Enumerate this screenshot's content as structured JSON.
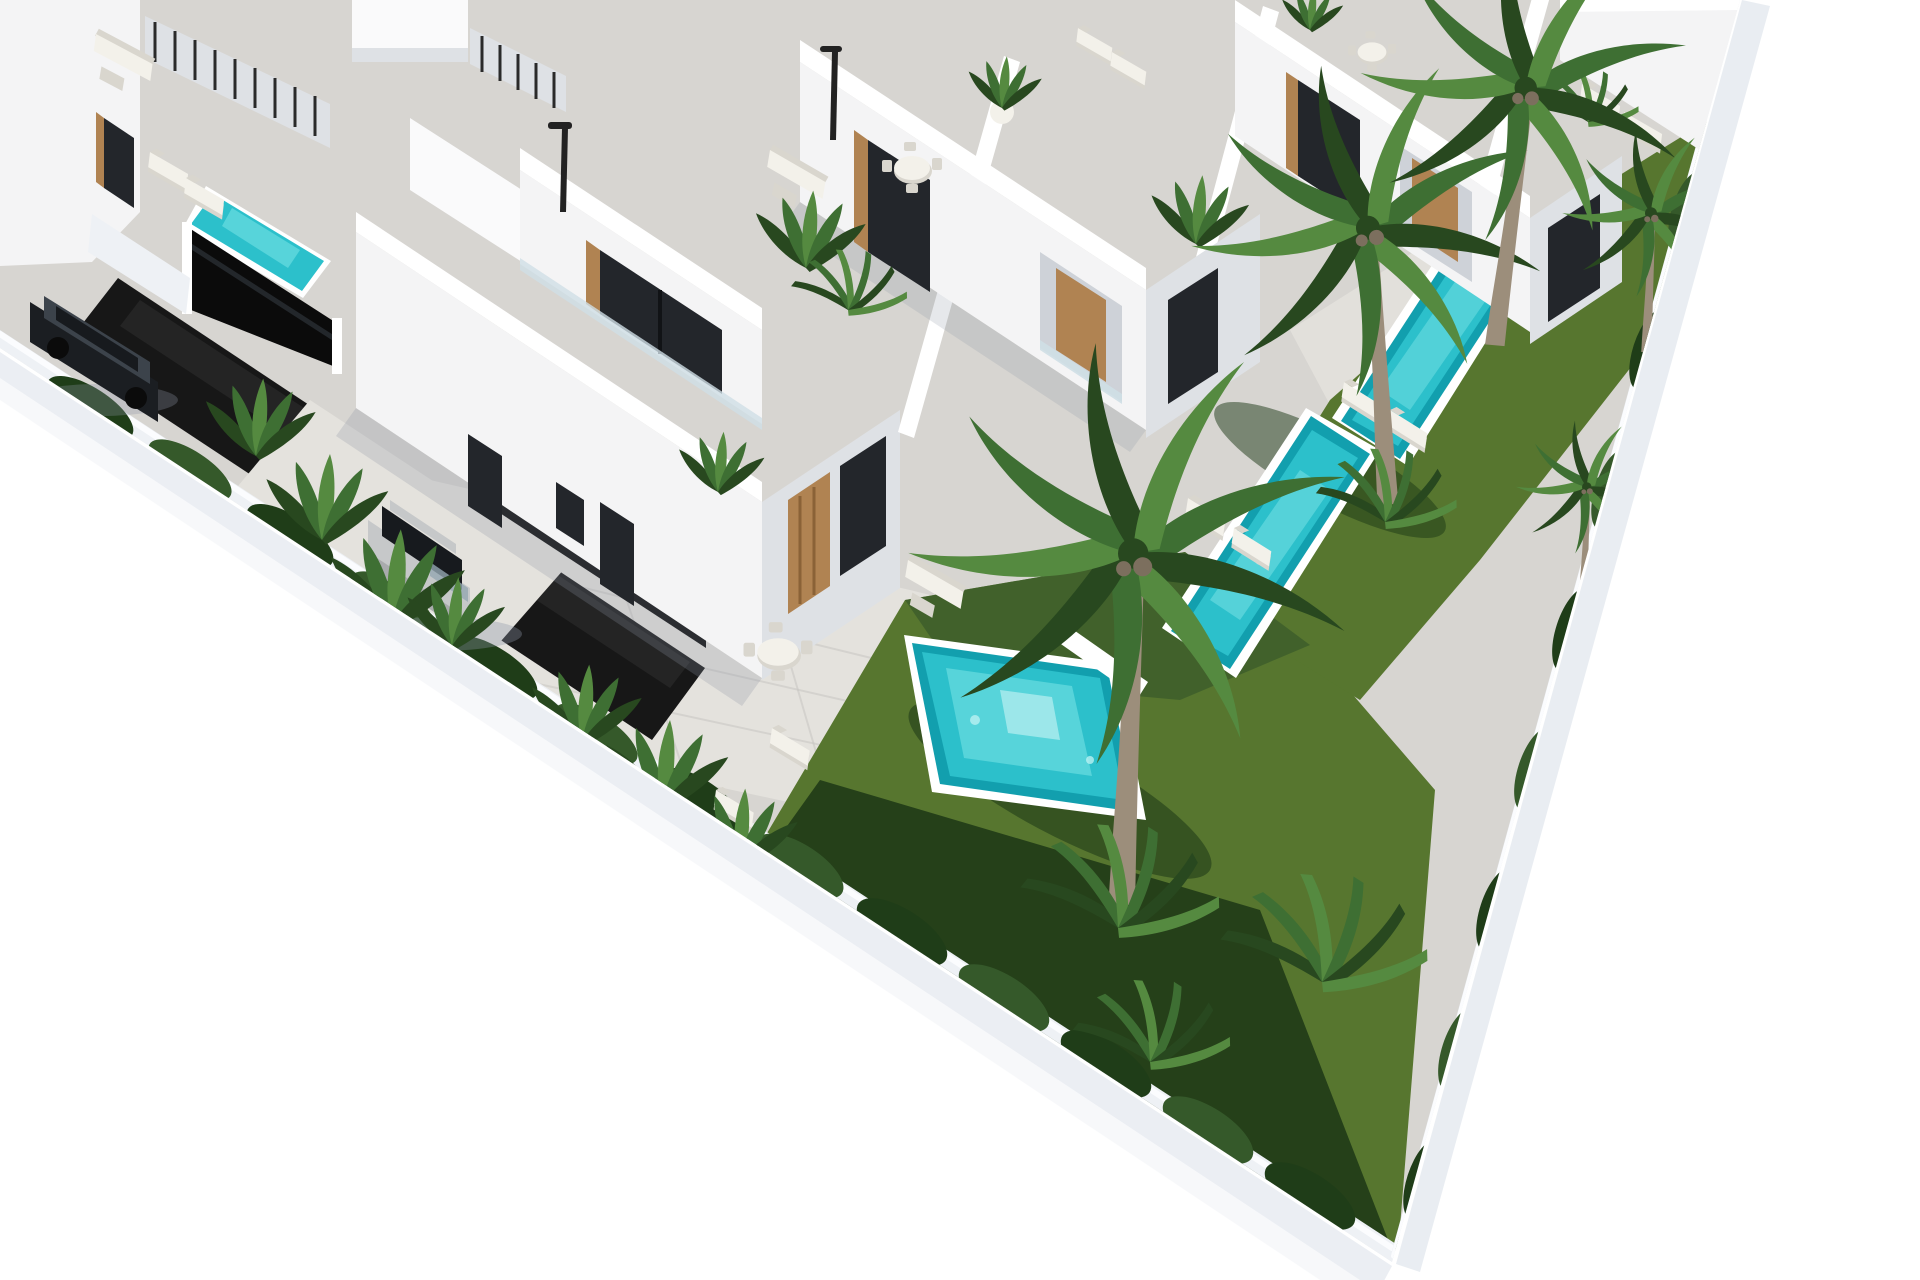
{
  "scene": {
    "description": "Aerial 3D architectural rendering of a gated development of modern white two-storey villas with rooftop terraces, private turquoise pools, white outdoor furniture, palm trees and landscaped dark-green gardens. A black road with dark entrance gates crosses the left side, a silver SUV is parked on a driveway and a black SUV waits behind a gate. The diagonally-cropped plot sits on a plain white background.",
    "objects": {
      "villas_visible": "8",
      "pools_visible": "4",
      "large_palm_trees": "3",
      "small_palms_and_fan_bushes": "6",
      "vehicles": [
        "silver-suv",
        "black-suv"
      ],
      "road": "dark asphalt lane with two black metal gates",
      "street_lamps": "2",
      "garden": "dark lawn, hedges, banana plants, sun loungers, dining sets, sofas"
    },
    "palette": {
      "bg": "#ffffff",
      "paving": "#d7d5d1",
      "paving_light": "#e4e2dd",
      "paving_shade": "#c7c5c1",
      "terrace_line": "#c6c4c0",
      "street": "#a7a7a5",
      "curb": "#ffffff",
      "road": "#171717",
      "gate": "#0b0b0b",
      "wall_face": "#eef1f5",
      "wall_top": "#fbfcfe",
      "wall_outer": "#e7ebf1",
      "villa_top": "#fafafb",
      "villa_sun": "#f4f4f5",
      "villa_shade": "#dee1e5",
      "villa_deep": "#ced2d8",
      "parapet": "#ffffff",
      "glass": "#23262b",
      "wood": "#b08352",
      "wood_dark": "#8a6237",
      "glass_rail": "#cfdfe6",
      "pool": "#2cc0cb",
      "pool_light": "#63d8dd",
      "pool_deep": "#129fae",
      "pool_sparkle": "#b9f0f1",
      "lawn": "#57762f",
      "lawn_dark": "#3c5c2b",
      "lawn_shadow": "#1c3715",
      "hedge": "#1f3d18",
      "hedge_light": "#35592a",
      "frond": "#3e6f33",
      "frond_dark": "#28481f",
      "frond_light": "#558a40",
      "trunk": "#9c8e7b",
      "trunk_dark": "#7c6f5e",
      "furn": "#f3f1ea",
      "furn_shade": "#d9d6ce",
      "furn_frame": "#8e8e8c",
      "suv_silver": "#c6c8c9",
      "suv_silver_dark": "#a9abad",
      "suv_glass": "#171a1e",
      "suv_hilite": "#95a7b2",
      "suv_black": "#1b1e22",
      "suv_black_hi": "#3c434b",
      "lamp": "#222222",
      "shadow": "#8d95a5"
    }
  }
}
